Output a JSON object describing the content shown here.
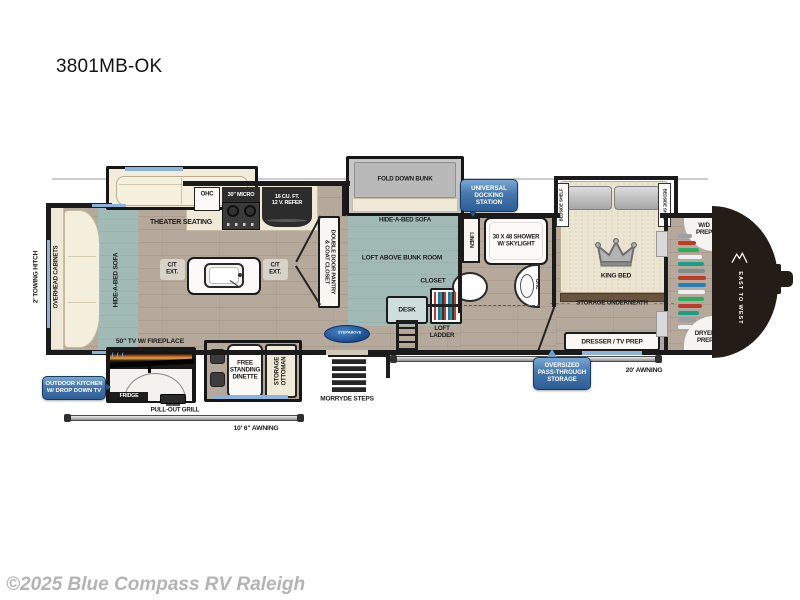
{
  "title": "3801MB-OK",
  "copyright": "©2025 Blue Compass RV Raleigh",
  "colors": {
    "badge_blue": "#2d5e95",
    "window_blue": "#8ab4dd",
    "rug_teal": "#a2bab6",
    "wall": "#1b1b1b",
    "floor_tan": "#b5a99b"
  },
  "exterior": {
    "towing_hitch": "2' TOWING HITCH",
    "awning_left": "10' 6\" AWNING",
    "awning_right": "20' AWNING",
    "brand_logo": "EAST TO WEST",
    "steps": "MORRYDE STEPS",
    "step_logo": "STEPABOVE"
  },
  "badges": {
    "outdoor_kitchen": "OUTDOOR KITCHEN\nW/ DROP DOWN TV",
    "docking_station": "UNIVERSAL\nDOCKING\nSTATION",
    "pass_through": "OVERSIZED\nPASS-THROUGH\nSTORAGE"
  },
  "living": {
    "overhead_cabinets": "OVERHEAD CABINETS",
    "hide_a_bed_sofa": "HIDE-A-BED SOFA",
    "theater_seating": "THEATER SEATING",
    "tv_fireplace": "50\" TV W/ FIREPLACE"
  },
  "kitchen": {
    "ohc": "OHC",
    "micro": "30\" MICRO",
    "refer": "16 CU. FT.\n12 V. REFER",
    "ct_ext": "C/T\nEXT.",
    "pantry": "DOUBLE DOOR PANTRY\n& COAT CLOSET"
  },
  "outdoor_kitchen": {
    "fridge": "FRIDGE",
    "grill": "PULL-OUT GRILL"
  },
  "dinette": {
    "table": "FREE\nSTANDING\nDINETTE",
    "ottoman": "STORAGE\nOTTOMAN"
  },
  "bunk_room": {
    "fold_down_bunk": "FOLD DOWN BUNK",
    "hide_a_bed_sofa": "HIDE-A-BED SOFA",
    "loft": "LOFT ABOVE BUNK ROOM",
    "desk": "DESK",
    "closet": "CLOSET",
    "loft_ladder": "LOFT\nLADDER"
  },
  "bath": {
    "linen": "LINEN",
    "shower": "30 X 48 SHOWER\nW/ SKYLIGHT",
    "ohc": "OHC"
  },
  "bedroom": {
    "king_bed": "KING BED",
    "bedside_shelf": "BEDSIDE SHELF",
    "storage_underneath": "STORAGE UNDERNEATH",
    "dresser": "DRESSER / TV PREP"
  },
  "rear": {
    "wd_prep": "W/D\nPREP",
    "dryer_prep": "DRYER\nPREP"
  }
}
